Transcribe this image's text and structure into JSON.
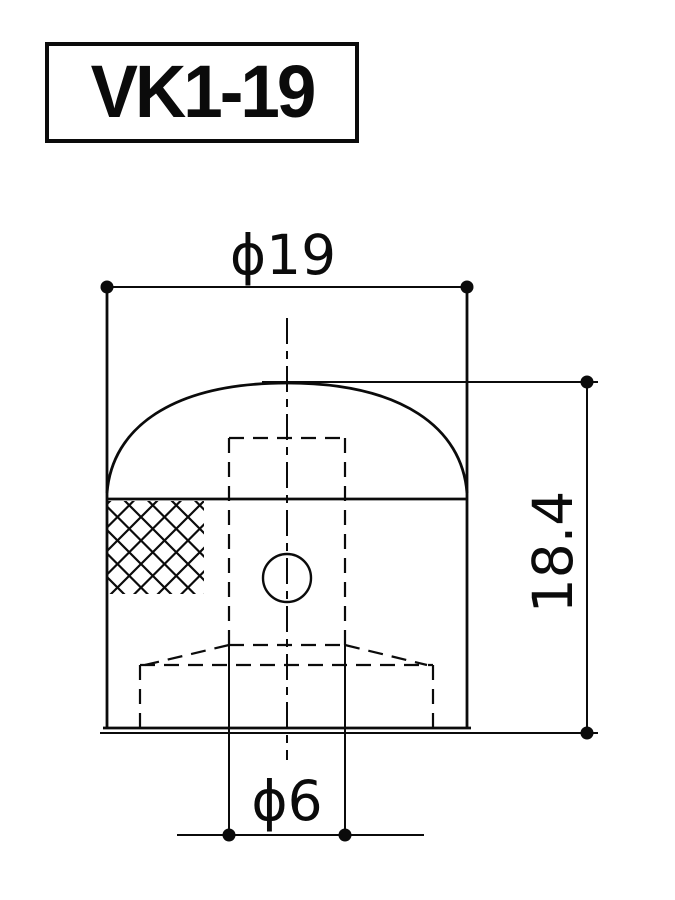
{
  "part_label": "VK1-19",
  "dimensions": {
    "diameter_top": "ϕ19",
    "height_right": "18.4",
    "diameter_bottom": "ϕ6"
  },
  "colors": {
    "line": "#0b0b0b",
    "background": "#ffffff"
  }
}
